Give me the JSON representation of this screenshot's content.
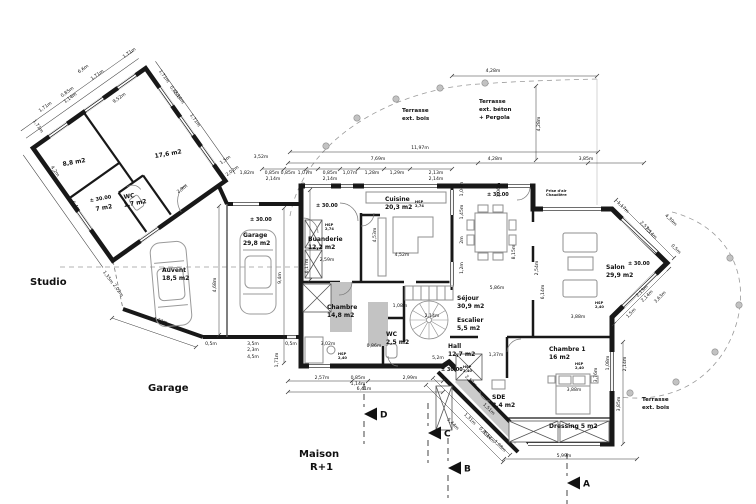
{
  "drawing": {
    "type": "floor-plan",
    "level_mark": "± 30.00",
    "colors": {
      "wall": "#181818",
      "furniture": "#8f8f8f",
      "gray_fill": "#c3c3c3",
      "terrace_line": "#9a9a9a",
      "dot_fill": "#c2c2c2",
      "dim": "#222222"
    }
  },
  "site_labels": [
    {
      "text": "Studio",
      "x": 30,
      "y": 285
    },
    {
      "text": "Garage",
      "x": 148,
      "y": 391
    },
    {
      "text": "Maison",
      "x": 299,
      "y": 457
    },
    {
      "text": "R+1",
      "x": 310,
      "y": 470
    }
  ],
  "rooms": [
    {
      "name": "Cuisine",
      "area": "20,3 m2",
      "x": 385,
      "y": 201,
      "rot": 0
    },
    {
      "name": "Buanderie",
      "area": "12,2 m2",
      "x": 308,
      "y": 241,
      "rot": 0
    },
    {
      "name": "Garage",
      "area": "29,8 m2",
      "x": 243,
      "y": 237,
      "rot": 0
    },
    {
      "name": "Auvent",
      "area": "18,5 m2",
      "x": 162,
      "y": 272,
      "rot": 0
    },
    {
      "name": "Chambre",
      "area": "14,8 m2",
      "x": 327,
      "y": 309,
      "rot": 0
    },
    {
      "name": "WC",
      "area": "2,5 m2",
      "x": 386,
      "y": 336,
      "rot": 0
    },
    {
      "name": "Séjour",
      "area": "30,9 m2",
      "x": 457,
      "y": 300,
      "rot": 0
    },
    {
      "name": "Escalier",
      "area": "5,5 m2",
      "x": 457,
      "y": 322,
      "rot": 0
    },
    {
      "name": "Hall",
      "area": "12,7 m2",
      "x": 448,
      "y": 348,
      "rot": 0
    },
    {
      "name": "Salon",
      "area": "29,9 m2",
      "x": 606,
      "y": 269,
      "rot": 0
    },
    {
      "name": "Chambre 1",
      "area": "16 m2",
      "x": 549,
      "y": 351,
      "rot": 0
    },
    {
      "name": "SDE",
      "area": "8,4 m2",
      "x": 492,
      "y": 399,
      "rot": 0
    },
    {
      "name": "Dressing 5 m2",
      "area": "",
      "x": 549,
      "y": 428,
      "rot": 0
    },
    {
      "name": "WC",
      "area": "1,7 m2",
      "x": 124,
      "y": 199,
      "rot": -10
    },
    {
      "name": "",
      "area": "8,8 m2",
      "x": 63,
      "y": 166,
      "rot": -10
    },
    {
      "name": "",
      "area": "17,6 m2",
      "x": 155,
      "y": 158,
      "rot": -10
    },
    {
      "name": "",
      "area": "7 m2",
      "x": 96,
      "y": 211,
      "rot": -10
    }
  ],
  "levels": [
    {
      "x": 90,
      "y": 202,
      "rot": -10
    },
    {
      "x": 250,
      "y": 221,
      "rot": 0
    },
    {
      "x": 316,
      "y": 207,
      "rot": 0
    },
    {
      "x": 487,
      "y": 196,
      "rot": 0
    },
    {
      "x": 441,
      "y": 371,
      "rot": 0
    },
    {
      "x": 628,
      "y": 265,
      "rot": 0
    }
  ],
  "notes": [
    {
      "l1": "HSP",
      "l2": "2,74",
      "x": 415,
      "y": 203
    },
    {
      "l1": "HSP",
      "l2": "2,74",
      "x": 325,
      "y": 226
    },
    {
      "l1": "HSP",
      "l2": "2,40",
      "x": 338,
      "y": 355
    },
    {
      "l1": "HSP",
      "l2": "2,40",
      "x": 463,
      "y": 368
    },
    {
      "l1": "HSP",
      "l2": "2,40",
      "x": 595,
      "y": 304
    },
    {
      "l1": "HSP",
      "l2": "2,40",
      "x": 575,
      "y": 365
    },
    {
      "l1": "Prise d'air",
      "l2": "Chaudière",
      "x": 546,
      "y": 192
    }
  ],
  "terrace_labels": [
    {
      "lines": [
        "Terrasse",
        "ext. bois"
      ],
      "x": 402,
      "y": 112
    },
    {
      "lines": [
        "Terrasse",
        "ext. béton",
        "+ Pergola"
      ],
      "x": 479,
      "y": 103
    },
    {
      "lines": [
        "Terrasse",
        "ext. bois"
      ],
      "x": 642,
      "y": 401
    }
  ],
  "sections": [
    {
      "label": "D",
      "x": 364,
      "y": 414
    },
    {
      "label": "C",
      "x": 428,
      "y": 433
    },
    {
      "label": "B",
      "x": 448,
      "y": 468
    },
    {
      "label": "A",
      "x": 567,
      "y": 483
    }
  ],
  "dimensions": [
    [
      "11,97m",
      420,
      149,
      0
    ],
    [
      "7,69m",
      378,
      160,
      0
    ],
    [
      "4,28m",
      495,
      160,
      0
    ],
    [
      "3,85m",
      586,
      160,
      0
    ],
    [
      "4,28m",
      493,
      72,
      0
    ],
    [
      "4,28m",
      540,
      124,
      -90
    ],
    [
      "3,52m",
      261,
      158,
      0
    ],
    [
      "1,82m",
      247,
      174,
      0
    ],
    [
      "0,85m",
      272,
      174,
      0
    ],
    [
      "0,85m",
      288,
      174,
      0
    ],
    [
      "2,14m",
      273,
      180,
      0
    ],
    [
      "1,07m",
      305,
      174,
      0
    ],
    [
      "0,85m",
      330,
      174,
      0
    ],
    [
      "2,14m",
      330,
      180,
      0
    ],
    [
      "1,07m",
      350,
      174,
      0
    ],
    [
      "1,28m",
      372,
      174,
      0
    ],
    [
      "1,29m",
      397,
      174,
      0
    ],
    [
      "2,13m",
      436,
      174,
      0
    ],
    [
      "2,14m",
      436,
      180,
      0
    ],
    [
      "1,06m",
      500,
      190,
      -90
    ],
    [
      "1,06m",
      463,
      189,
      -90
    ],
    [
      "1,45m",
      463,
      212,
      -90
    ],
    [
      "2m",
      463,
      240,
      -90
    ],
    [
      "1,2m",
      463,
      268,
      -90
    ],
    [
      "8,15m",
      515,
      252,
      -90
    ],
    [
      "5,86m",
      497,
      289,
      0
    ],
    [
      "4,68m",
      216,
      285,
      -90
    ],
    [
      "9,4m",
      281,
      278,
      -90
    ],
    [
      "6,17m",
      308,
      266,
      -90
    ],
    [
      "0,5m",
      211,
      345,
      0
    ],
    [
      "3,5m",
      253,
      345,
      0
    ],
    [
      "2,3m",
      253,
      351,
      0
    ],
    [
      "4,5m",
      253,
      358,
      0
    ],
    [
      "0,5m",
      291,
      345,
      0
    ],
    [
      "3,02m",
      328,
      345,
      0
    ],
    [
      "1,71m",
      278,
      360,
      -90
    ],
    [
      "4,32m",
      160,
      322,
      19
    ],
    [
      "2,57m",
      322,
      379,
      0
    ],
    [
      "0,85m",
      358,
      379,
      0
    ],
    [
      "1,14m",
      358,
      385,
      0
    ],
    [
      "2,99m",
      410,
      379,
      0
    ],
    [
      "6,41m",
      364,
      390,
      0
    ],
    [
      "0,86m",
      374,
      347,
      0
    ],
    [
      "1,08m",
      400,
      307,
      0
    ],
    [
      "2,14m",
      432,
      317,
      0
    ],
    [
      "4,52m",
      402,
      256,
      0
    ],
    [
      "4,53m",
      376,
      235,
      -90
    ],
    [
      "2,59m",
      327,
      261,
      0
    ],
    [
      "5,2m",
      438,
      359,
      0
    ],
    [
      "1,37m",
      496,
      356,
      0
    ],
    [
      "2,54m",
      538,
      268,
      -90
    ],
    [
      "6,14m",
      544,
      292,
      -90
    ],
    [
      "3,88m",
      578,
      318,
      0
    ],
    [
      "3,88m",
      574,
      391,
      0
    ],
    [
      "3,76m",
      597,
      375,
      -90
    ],
    [
      "1,17m",
      622,
      208,
      45
    ],
    [
      "4,39m",
      670,
      221,
      45
    ],
    [
      "2,57m",
      645,
      228,
      45
    ],
    [
      "2,14m",
      650,
      234,
      45
    ],
    [
      "0,5m",
      675,
      250,
      45
    ],
    [
      "2,13m",
      643,
      292,
      -45
    ],
    [
      "2,14m",
      648,
      297,
      -45
    ],
    [
      "3,63m",
      661,
      298,
      -45
    ],
    [
      "1,5m",
      632,
      314,
      -45
    ],
    [
      "3,85m",
      620,
      404,
      -90
    ],
    [
      "2,14m",
      626,
      364,
      -90
    ],
    [
      "1,08m",
      609,
      363,
      -90
    ],
    [
      "5,99m",
      564,
      457,
      0
    ],
    [
      "2,17m",
      470,
      382,
      45
    ],
    [
      "1,51m",
      488,
      410,
      45
    ],
    [
      "5,44m",
      452,
      425,
      45
    ],
    [
      "1,31m",
      469,
      420,
      45
    ],
    [
      "0,85m",
      484,
      434,
      45
    ],
    [
      "1,14m",
      488,
      438,
      45
    ],
    [
      "1,08m",
      499,
      447,
      45
    ],
    [
      "1,71m",
      46,
      108,
      -35
    ],
    [
      "0,85m",
      68,
      93,
      -35
    ],
    [
      "1,14m",
      71,
      99,
      -35
    ],
    [
      "6,6m",
      84,
      70,
      -35
    ],
    [
      "1,71m",
      98,
      76,
      -35
    ],
    [
      "1,71m",
      130,
      54,
      -35
    ],
    [
      "1,71m",
      163,
      77,
      55
    ],
    [
      "0,85m",
      174,
      93,
      55
    ],
    [
      "2,14m",
      178,
      98,
      55
    ],
    [
      "1,71m",
      194,
      121,
      55
    ],
    [
      "9,52m",
      120,
      99,
      -35
    ],
    [
      "2,9m",
      183,
      190,
      -35
    ],
    [
      "1,71m",
      37,
      127,
      55
    ],
    [
      "4,2m",
      54,
      172,
      55
    ],
    [
      "6,4m",
      75,
      207,
      55
    ],
    [
      "1,5m",
      226,
      161,
      -35
    ],
    [
      "2,02m",
      233,
      172,
      -35
    ],
    [
      "1,35m",
      107,
      278,
      55
    ],
    [
      "2,02m",
      117,
      291,
      55
    ]
  ]
}
